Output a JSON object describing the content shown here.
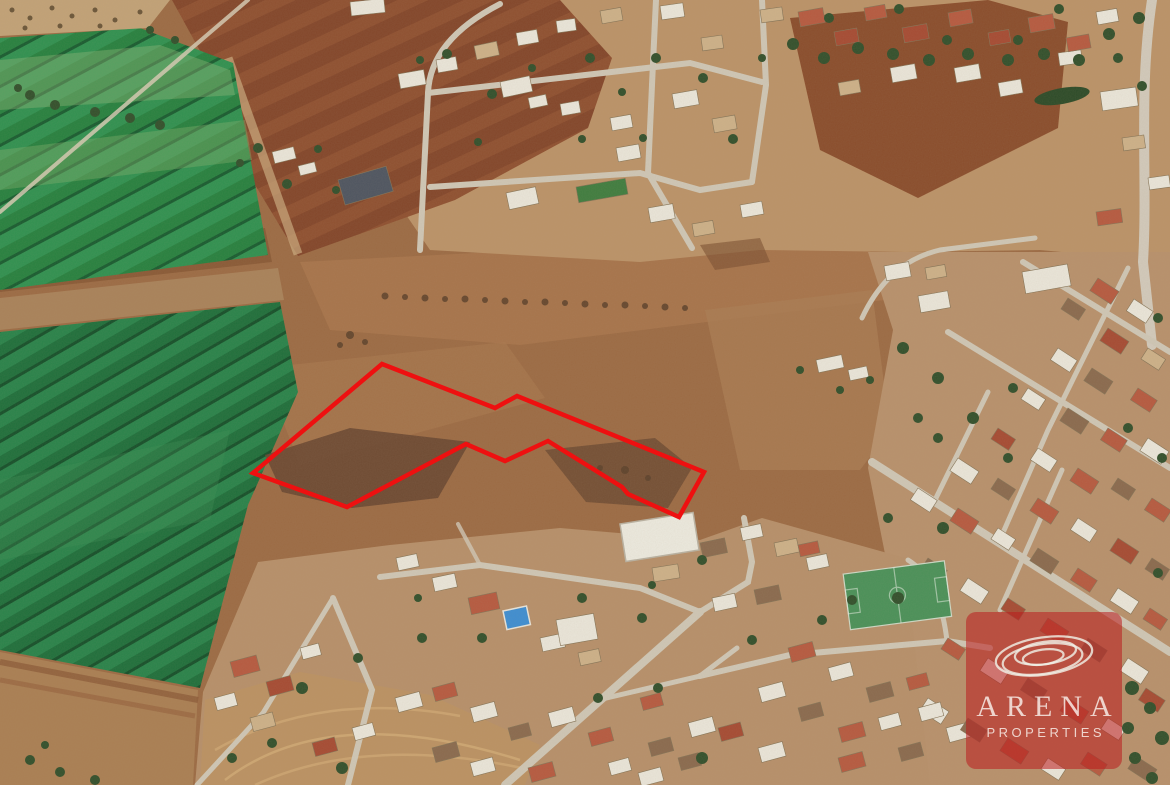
{
  "photo": {
    "kind": "satellite-aerial-photo",
    "subject": "land parcel outlined in red among fields and suburban houses"
  },
  "parcel": {
    "points": "382,364 495,408 517,396 704,472 679,517 628,494 622,487 548,441 505,461 466,444 347,507 253,473",
    "outline_color": "#ee1010"
  },
  "watermark": {
    "brand": "ARENA",
    "tagline": "PROPERTIES",
    "logo": "concentric-ellipses-icon",
    "bg_color": "rgba(187,27,30,0.55)",
    "text_color": "rgba(252,250,245,0.78)"
  },
  "palette": {
    "parcel-red": "#ee1010",
    "watermark-bg": "rgba(187,27,30,0.55)",
    "watermark-text": "rgba(252,250,245,0.78)",
    "terrain-base": "#9c6b44",
    "field-green": "#278045",
    "field-green-dark": "#1d6a38",
    "plow-brown": "#85482b",
    "suburb-tan": "#bb9368",
    "road-gray": "#cfc7b6",
    "roof-red": "#b65a40",
    "roof-white": "#eae6da",
    "pitch-green": "#4a9159",
    "pool-blue": "#3e8ed2"
  }
}
